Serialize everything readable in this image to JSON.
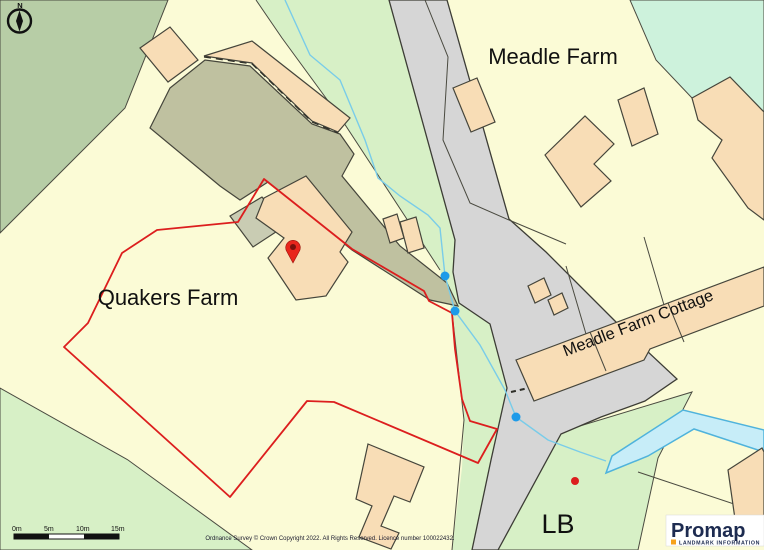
{
  "map": {
    "place_labels": [
      {
        "id": "meadle-farm",
        "text": "Meadle Farm"
      },
      {
        "id": "quakers-farm",
        "text": "Quakers Farm"
      },
      {
        "id": "meadle-farm-cottage",
        "text": "Meadle Farm Cottage"
      },
      {
        "id": "lb",
        "text": "LB"
      }
    ],
    "compass": {
      "label": "N"
    },
    "scale_bar": {
      "labels": [
        "0m",
        "5m",
        "10m",
        "15m"
      ]
    },
    "attribution": "Ordnance Survey © Crown Copyright 2022. All Rights Reserved. Licence number 100022432.",
    "logo": {
      "brand": "Promap",
      "tagline": "LANDMARK INFORMATION"
    },
    "colors": {
      "field_yellow": "#FBFBD6",
      "field_green": "#D7F0C6",
      "field_sage": "#B7CDA6",
      "field_mint": "#CDF2DC",
      "farm_yard": "#BFC1A0",
      "outbuilding_grey": "#C9CCB3",
      "building_peach": "#F8DDB6",
      "road_grey": "#D6D6D6",
      "line_dark": "#45453b",
      "boundary_red": "#DC1E1E",
      "water_fill": "#C7EDF8",
      "water_edge": "#4FB3DC",
      "stream_blue": "#79CCE9",
      "node_blue": "#1E9BE9",
      "pin_red": "#E8251C",
      "logo_navy": "#1D2B50",
      "logo_orange": "#F6A21B"
    }
  }
}
